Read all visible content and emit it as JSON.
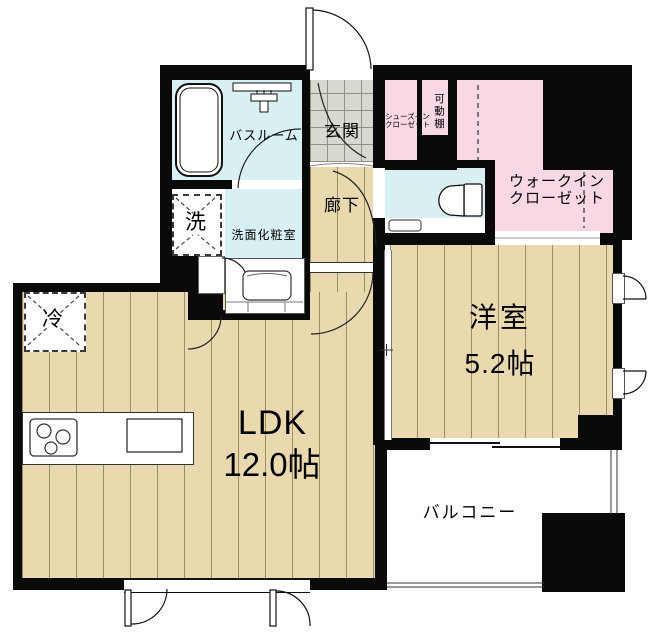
{
  "floorplan": {
    "rooms": {
      "bathroom": {
        "label": "バスルーム"
      },
      "washroom": {
        "label": "洗面化粧室"
      },
      "washer": {
        "label": "洗"
      },
      "refrigerator": {
        "label": "冷"
      },
      "entrance": {
        "label": "玄関"
      },
      "hallway": {
        "label": "廊下"
      },
      "shoes_closet": {
        "label_line1": "シューズイン",
        "label_line2": "クローゼット"
      },
      "movable_shelf": {
        "label": "可動棚"
      },
      "walkin_closet": {
        "label_line1": "ウォークイン",
        "label_line2": "クローゼット"
      },
      "western_room": {
        "label": "洋室",
        "size": "5.2帖"
      },
      "ldk": {
        "label": "LDK",
        "size": "12.0帖"
      },
      "balcony": {
        "label": "バルコニー"
      }
    },
    "colors": {
      "wall": "#0a0a0a",
      "wood_floor": "#ead9af",
      "wet_area": "#d9f0f3",
      "closet": "#f9d7e5",
      "entrance_tile": "#d8d8cf"
    }
  }
}
